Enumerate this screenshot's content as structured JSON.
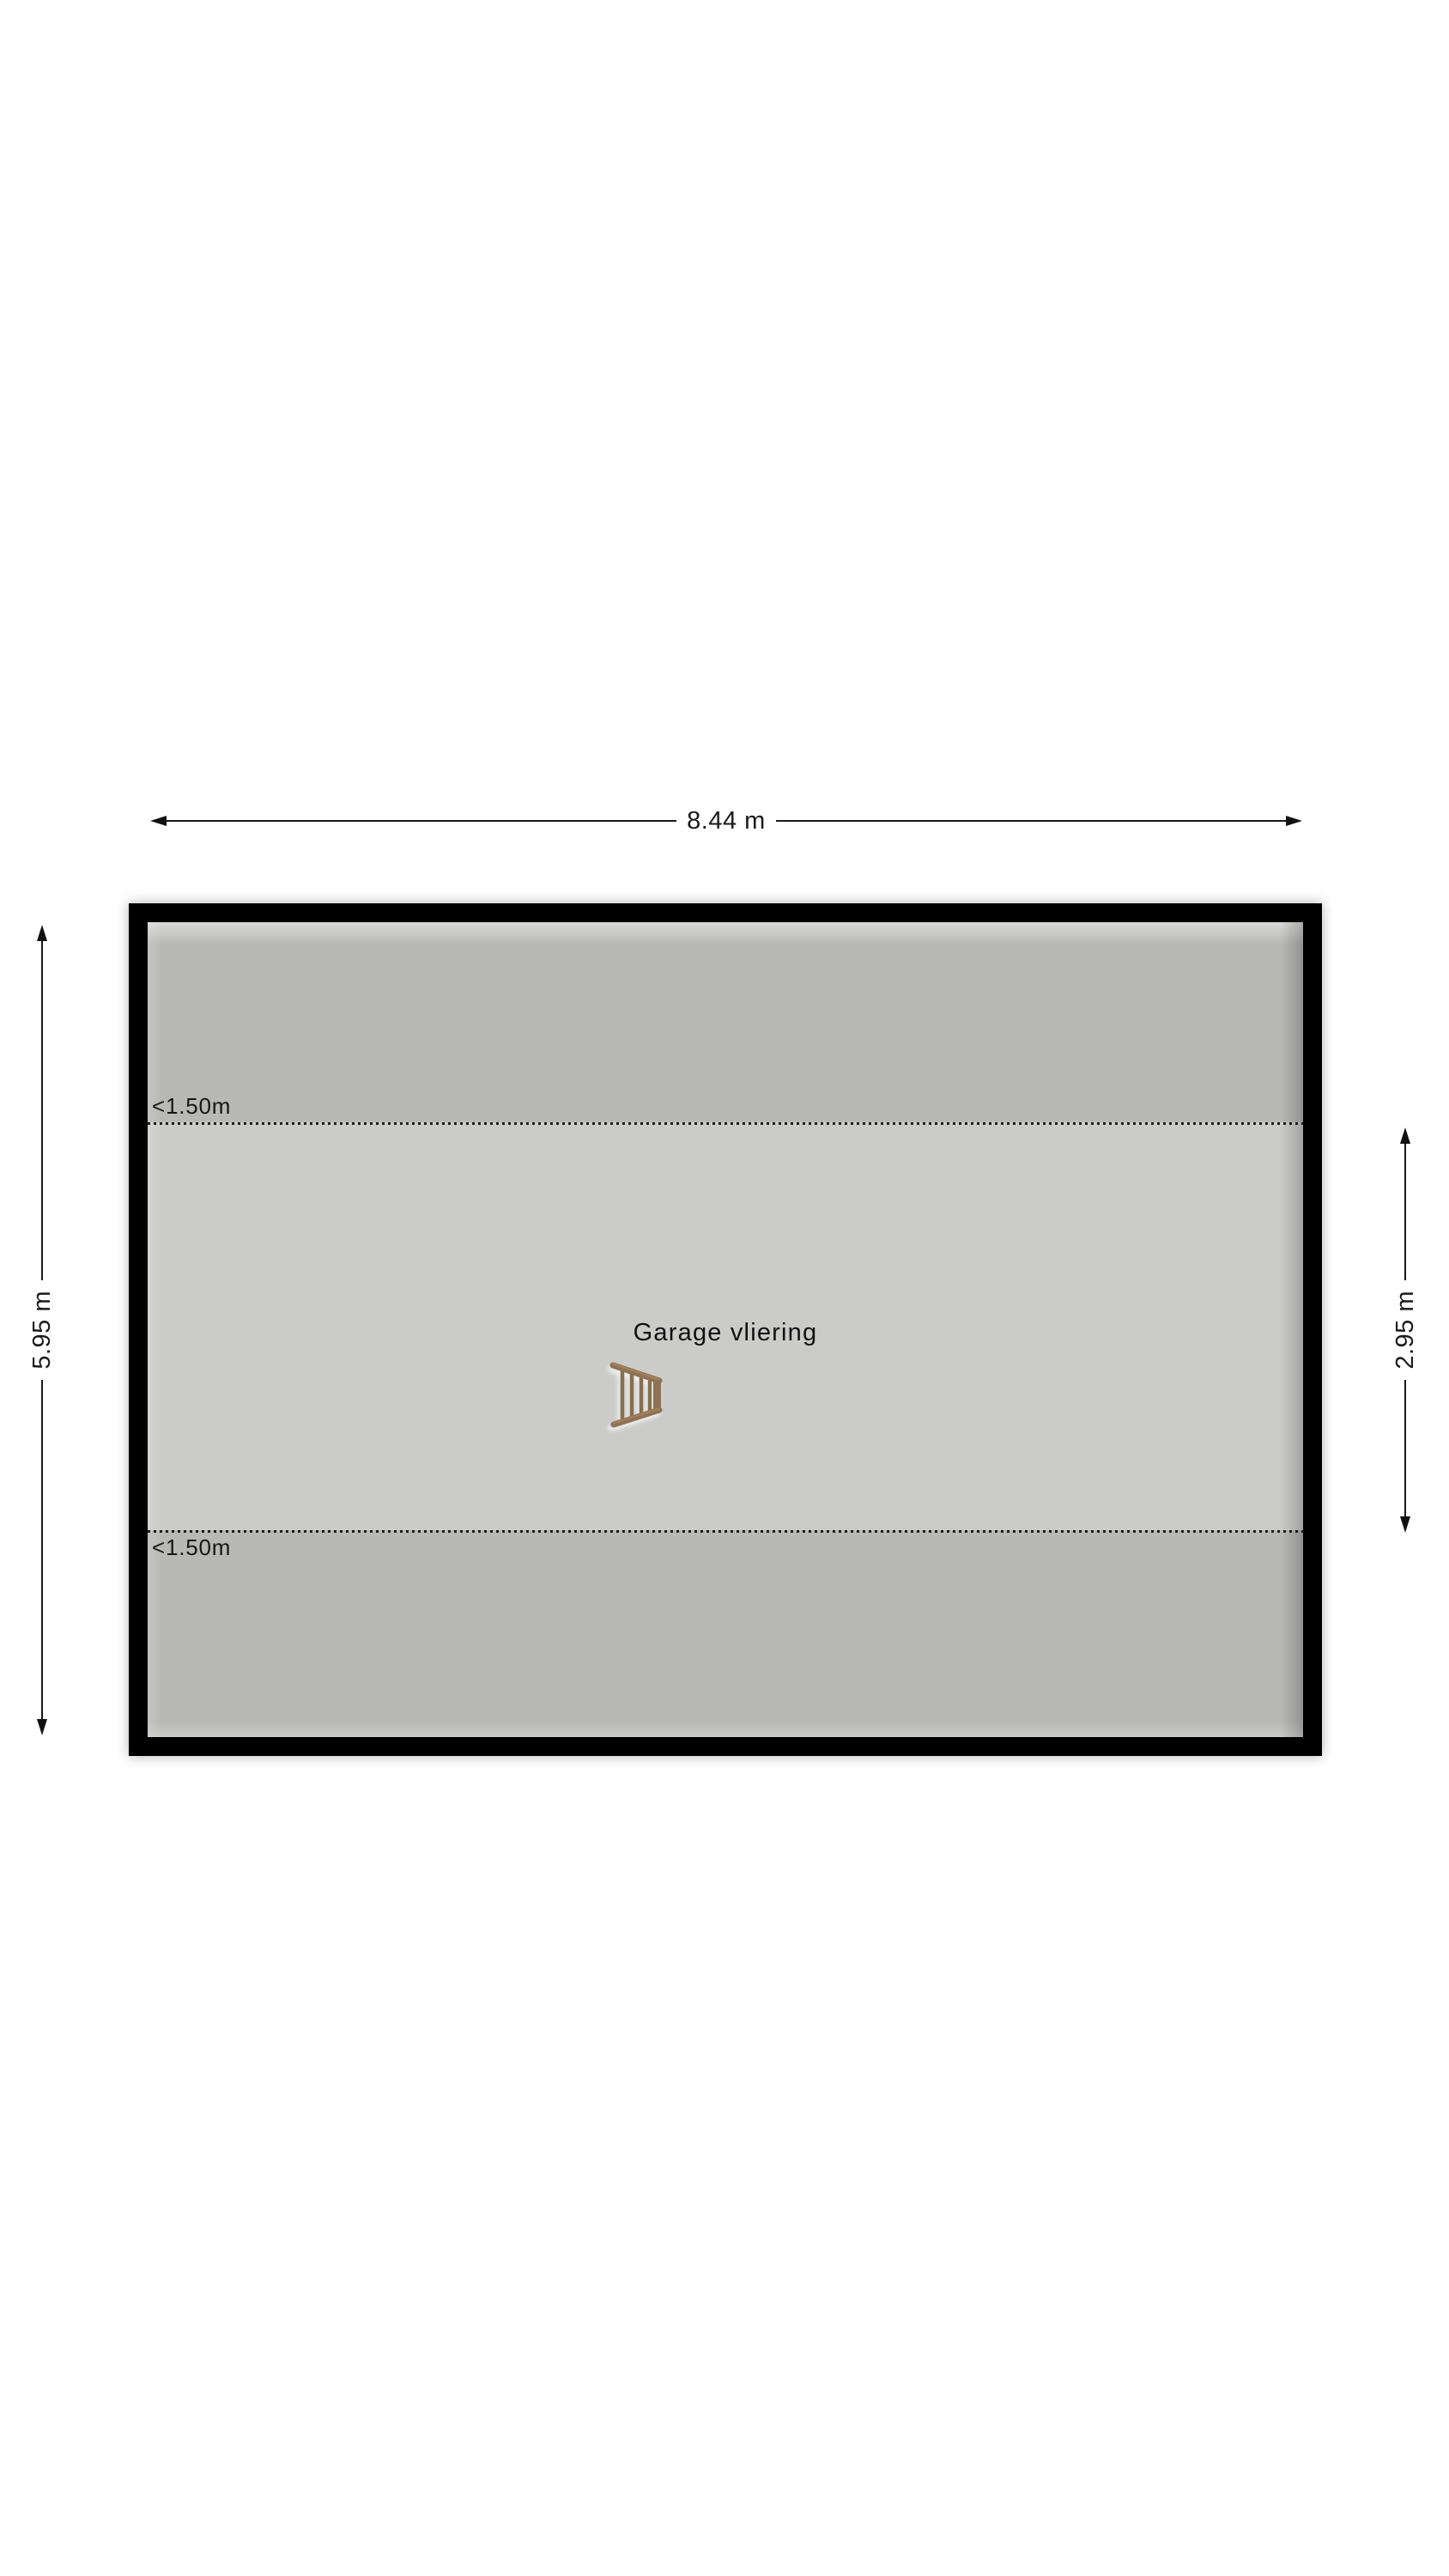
{
  "floorplan": {
    "room_label": "Garage vliering",
    "dimensions": {
      "width": "8.44 m",
      "height": "5.95 m",
      "middle_height": "2.95 m"
    },
    "height_markers": {
      "top": "<1.50m",
      "bottom": "<1.50m"
    },
    "icons": {
      "ladder": "ladder-icon"
    },
    "colors": {
      "wall": "#000000",
      "low_headroom_area": "#b8b8b6",
      "full_height_area": "#cbcbca",
      "dimension_line": "#1a1a1a",
      "text": "#1a1a1a",
      "ladder_wood_rail": "#8d7254",
      "ladder_wood_rung": "#87704f"
    }
  }
}
